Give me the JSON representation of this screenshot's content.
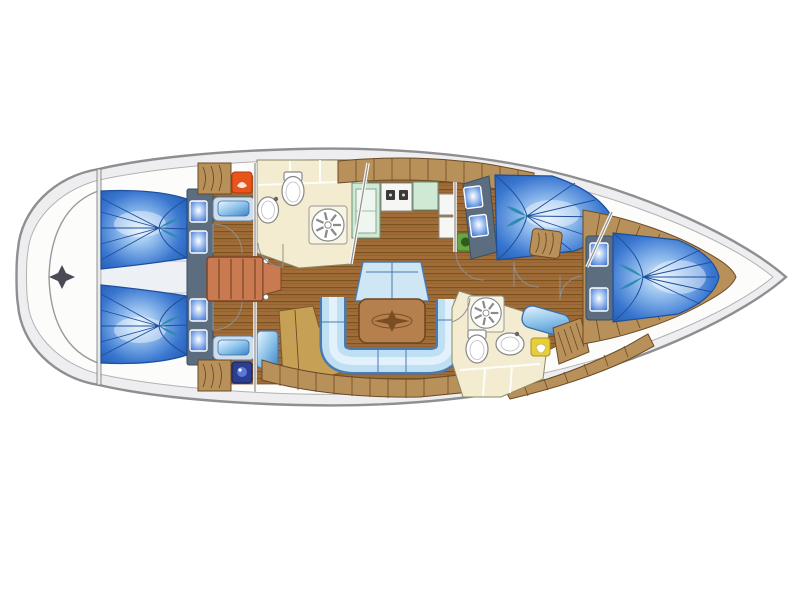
{
  "figure": {
    "type": "sailing-yacht-interior-floor-plan",
    "view": "top-down",
    "bow_direction": "right",
    "canvas": {
      "width": 800,
      "height": 599
    }
  },
  "regions": {
    "swim_platform": "swim-platform",
    "aft_cabin_top": "aft-double-cabin-top",
    "aft_cabin_bottom": "aft-double-cabin-bottom",
    "companionway": "companionway-steps",
    "aft_head": "aft-bathroom",
    "galley": "galley",
    "salon": "salon-settee-and-table",
    "forward_cabin_top": "forward-cabin-top",
    "forward_head": "forward-bathroom",
    "bow_cabin": "bow-v-berth-cabin",
    "anchor_locker": "bow-anchor-locker"
  },
  "palette": {
    "hull_outline": "#8f8f92",
    "hull_deck": "#eeeef0",
    "deck_inner": "#fcfcfb",
    "wood_floor": "#a06c38",
    "wood_stripe": "#7c521f",
    "cabinet_tan": "#b8905a",
    "cabinet_outline": "#6b4a26",
    "headboard_slate": "#5c6d80",
    "pillow_blue": "#4a86d8",
    "berth_blue_deep": "#1f55a8",
    "berth_blue_light": "#ddeefb",
    "fold_blue": "#1d4f9c",
    "teal_fold": "#2e8ab0",
    "settee_fill": "#bfe0f2",
    "settee_border": "#4a7ab0",
    "settee_highlight": "#e2f1fb",
    "bench_blue": "#cfe6f5",
    "bathroom_cream": "#f3ecd0",
    "fixture_white": "#ffffff",
    "galley_green": "#cfe9d4",
    "stool_green": "#6aa544",
    "steps_terracotta": "#c97a50",
    "table_wood": "#b5804e",
    "compass_inlay": "#7a4e22",
    "chaise_tan": "#c6a055",
    "sink_blue": "#8fc4ea",
    "orange_fixture": "#e8541c",
    "navy_fixture": "#2a3f8f",
    "yellow_fixture": "#e8cf3a",
    "emblem_gray": "#4a4a55"
  }
}
